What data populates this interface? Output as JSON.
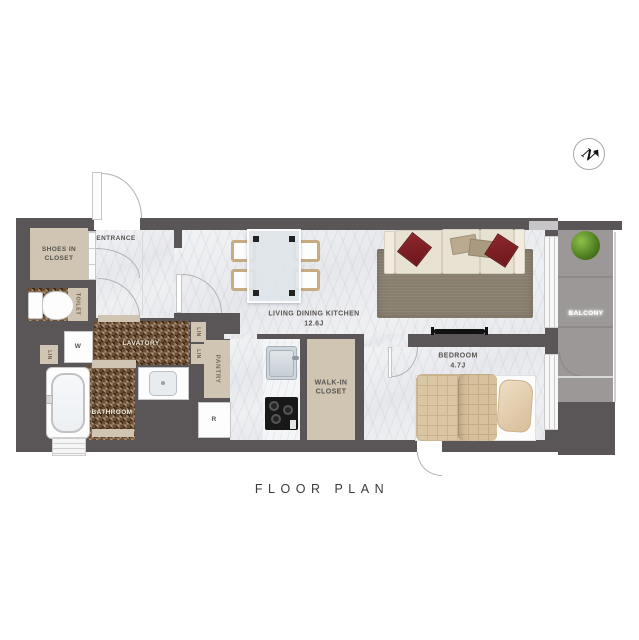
{
  "labels": {
    "entrance": "ENTRANCE",
    "shoes_closet_1": "SHOES IN",
    "shoes_closet_2": "CLOSET",
    "toilet": "TOILET",
    "washer": "W",
    "linen_hall": "LIN",
    "linen_upper": "LIN",
    "linen_lower": "LIN",
    "lavatory": "LAVATORY",
    "bathroom": "BATHROOM",
    "pantry": "PANTRY",
    "refrigerator": "R",
    "ldk_name": "LIVING DINING KITCHEN",
    "ldk_size": "12.6J",
    "wic_1": "WALK-IN",
    "wic_2": "CLOSET",
    "bedroom_name": "BEDROOM",
    "bedroom_size": "4.7J",
    "balcony": "BALCONY",
    "north": "N",
    "title": "FLOOR PLAN"
  },
  "colors": {
    "wall": "#5a5657",
    "floor_marble": "#ecedf0",
    "mosaic_brown": "#6b4e34",
    "closet_beige": "#cfc5b2",
    "balcony_gray": "#9b9897",
    "pillow_red": "#7d2025",
    "rug_taupe": "#897f6f",
    "bed_tan": "#dbc6a4",
    "plant_green": "#4e7d20"
  }
}
